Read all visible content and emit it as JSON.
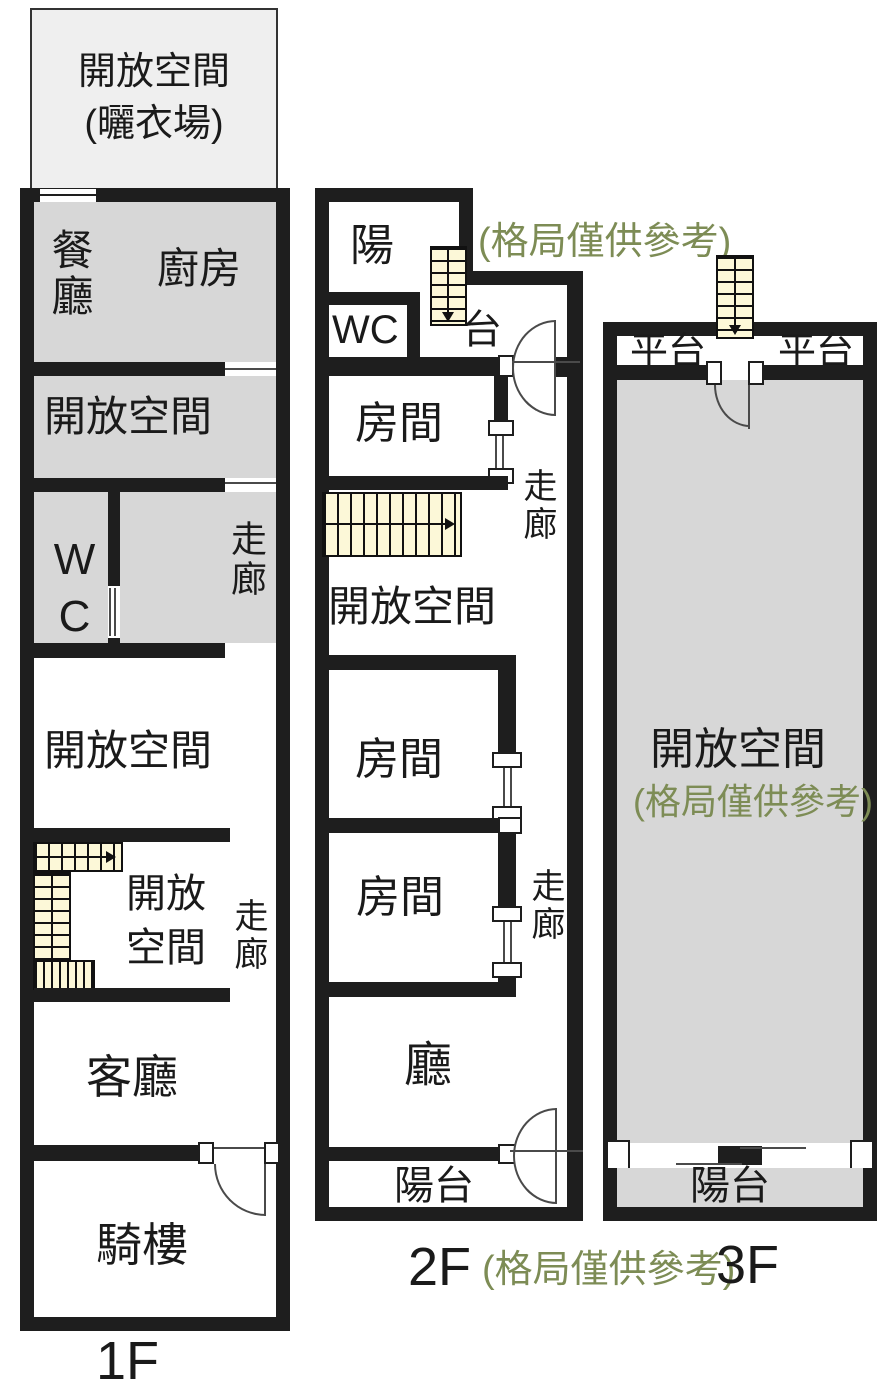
{
  "colors": {
    "wall": "#1e1e1e",
    "room_fill": "#d7d7d7",
    "stair_fill": "#fcf8d8",
    "note_green": "#7d8c55",
    "open_box_fill": "#efefef"
  },
  "floor1": {
    "open_box_line1": "開放空間",
    "open_box_line2": "(曬衣場)",
    "dining": "餐廳",
    "kitchen": "廚房",
    "open_area_upper": "開放空間",
    "wc": "WC",
    "corridor_upper": "走廊",
    "open_area_middle": "開放空間",
    "open_area_lower_line1": "開放",
    "open_area_lower_line2": "空間",
    "corridor_lower": "走廊",
    "living_room": "客廳",
    "arcade": "騎樓",
    "label": "1F"
  },
  "floor2": {
    "balcony_top_char1": "陽",
    "balcony_top_char2": "台",
    "wc": "WC",
    "bedroom_top": "房間",
    "open_area": "開放空間",
    "bedroom_middle": "房間",
    "bedroom_lower": "房間",
    "corridor_upper": "走廊",
    "corridor_lower": "走廊",
    "hall": "廳",
    "balcony_bottom": "陽台",
    "note_top": "(格局僅供參考)",
    "note_bottom": "(格局僅供參考)",
    "label": "2F"
  },
  "floor3": {
    "platform_left": "平台",
    "platform_right": "平台",
    "open_area": "開放空間",
    "note": "(格局僅供參考)",
    "balcony": "陽台",
    "label": "3F"
  }
}
